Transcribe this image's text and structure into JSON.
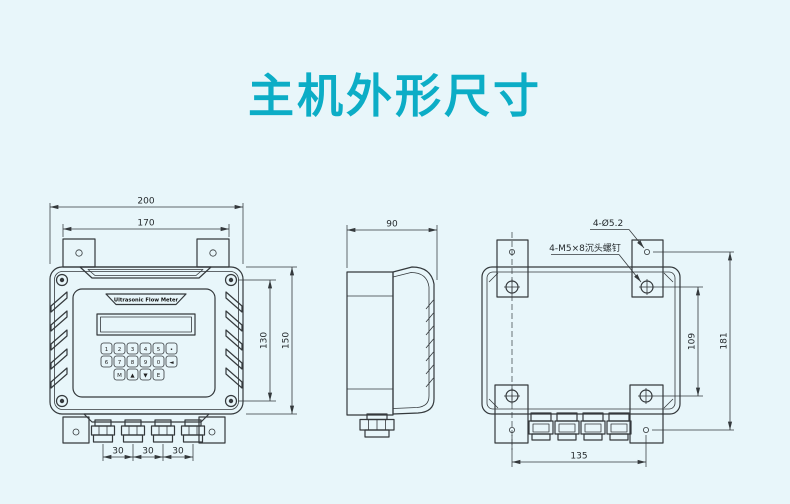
{
  "title": "主机外形尺寸",
  "colors": {
    "background": "#e8f6fa",
    "title": "#0cadc6",
    "line": "#34393c"
  },
  "device": {
    "brand_label": "Ultrasonic Flow Meter"
  },
  "keypad": {
    "rows": [
      [
        "1",
        "2",
        "3",
        "4",
        "5",
        "•"
      ],
      [
        "6",
        "7",
        "8",
        "9",
        "0",
        "◄"
      ],
      [
        "M",
        "▲",
        "▼",
        "E"
      ]
    ]
  },
  "views": {
    "front": {
      "dims": {
        "overall_width": "200",
        "mount_hole_spacing": "170",
        "screw_spacing_height": "130",
        "overall_height": "150",
        "gland_pitch": [
          "30",
          "30",
          "30"
        ]
      }
    },
    "side": {
      "dims": {
        "depth": "90"
      }
    },
    "rear": {
      "notes": {
        "bracket_hole": "4-Ø5.2",
        "screw": "4-M5×8沉头螺钉"
      },
      "dims": {
        "screw_spacing_height": "109",
        "bracket_hole_spacing_height": "181",
        "bottom_hole_spacing": "135"
      }
    }
  }
}
